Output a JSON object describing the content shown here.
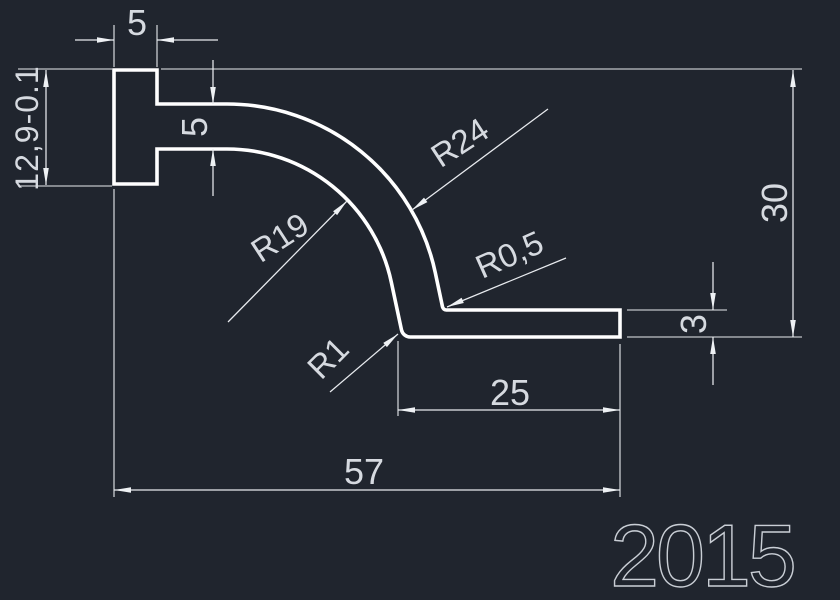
{
  "canvas": {
    "background": "#20252e",
    "geometry_color": "#ffffff",
    "dimension_color": "#e8ebef",
    "text_color": "#d6dae0",
    "title_color": "#c9ced5"
  },
  "dimensions": {
    "head_width": "5",
    "head_height": "12,9-0.1",
    "arm_thickness": "5",
    "overall_height": "30",
    "flange_thickness": "3",
    "flange_length": "25",
    "overall_width": "57"
  },
  "radii": {
    "inner_bend": "R19",
    "outer_bend": "R24",
    "inner_corner": "R0,5",
    "outer_corner": "R1"
  },
  "title_block": {
    "part_number": "2015"
  }
}
